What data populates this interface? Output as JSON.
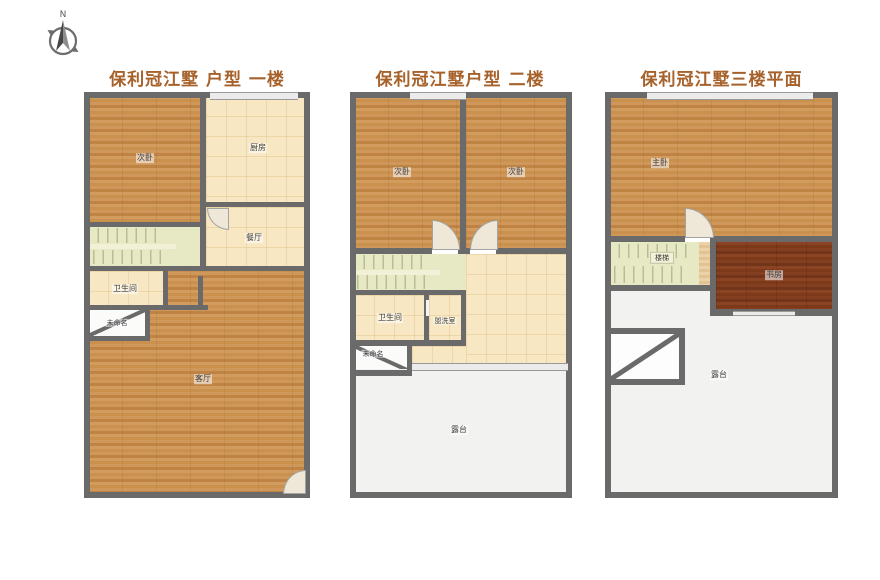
{
  "sheet": {
    "background": "#ffffff"
  },
  "compass": {
    "north_label": "N"
  },
  "colors": {
    "title_text": "#a7612a",
    "wall": "#6a6a6a",
    "wood_floor": "#cc9355",
    "dark_wood_floor": "#7c3a1b",
    "tile_floor": "#f7e7c2",
    "stair_floor": "#e6e9c4",
    "terrace_floor": "#f2f2f0"
  },
  "plans": {
    "floor1": {
      "title": "保利冠江墅 户型 一楼",
      "rooms": {
        "bedroom": "次卧",
        "kitchen": "厨房",
        "dining": "餐厅",
        "bathroom": "卫生间",
        "unnamed": "未命名",
        "living": "客厅"
      }
    },
    "floor2": {
      "title": "保利冠江墅户型 二楼",
      "rooms": {
        "bedroom_left": "次卧",
        "bedroom_right": "次卧",
        "bathroom": "卫生间",
        "washroom": "盥洗室",
        "unnamed": "未命名",
        "terrace": "露台"
      }
    },
    "floor3": {
      "title": "保利冠江墅三楼平面",
      "rooms": {
        "master_bedroom": "主卧",
        "stairs": "楼梯",
        "study": "书房",
        "terrace": "露台"
      }
    }
  }
}
